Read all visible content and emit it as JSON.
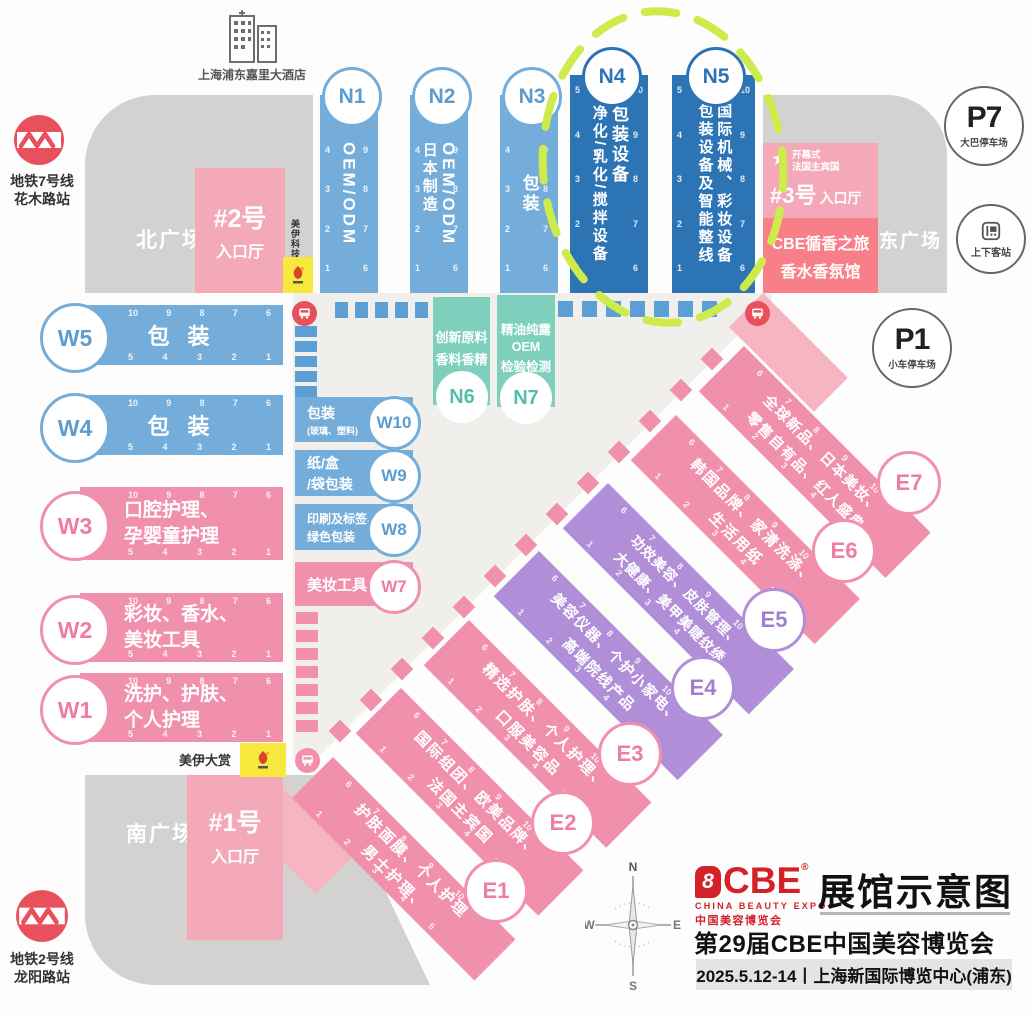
{
  "title_block": {
    "map_title": "展馆示意图",
    "expo_title": "第29届CBE中国美容博览会",
    "date_venue": "2025.5.12-14丨上海新国际博览中心(浦东)",
    "logo": {
      "mark": "8",
      "name": "CBE",
      "reg": "®",
      "en": "CHINA BEAUTY EXPO",
      "cn": "中国美容博览会"
    }
  },
  "compass": {
    "n": "N",
    "e": "E",
    "s": "S",
    "w": "W"
  },
  "transit": {
    "metro7": {
      "line": "地铁7号线",
      "station": "花木路站"
    },
    "metro2": {
      "line": "地铁2号线",
      "station": "龙阳路站"
    },
    "hotel": {
      "name": "上海浦东嘉里大酒店"
    },
    "p7": {
      "code": "P7",
      "label": "大巴停车场"
    },
    "p1": {
      "code": "P1",
      "label": "小车停车场"
    },
    "stop": {
      "label": "上下客站"
    }
  },
  "plazas": {
    "north": "北广场",
    "east": "东广场",
    "south": "南广场"
  },
  "entrances": {
    "no2": {
      "name": "#2号",
      "hall": "入口厅"
    },
    "no1": {
      "name": "#1号",
      "hall": "入口厅"
    },
    "no3": {
      "name": "#3号",
      "hall": "入口厅",
      "event1": "开幕式",
      "event2": "法国主宾国"
    }
  },
  "perfume_hall": {
    "line1": "CBE循香之旅",
    "line2": "香水香氛馆"
  },
  "sponsor": {
    "tech": "美伊科技",
    "award": "美伊大赏"
  },
  "n_halls": [
    {
      "id": "N1",
      "col1": "OEM/ODM"
    },
    {
      "id": "N2",
      "col1": "OEM/ODM",
      "col2": "日本制造"
    },
    {
      "id": "N3",
      "col1": "包装"
    },
    {
      "id": "N4",
      "col1": "包装设备",
      "col2": "净化/乳化/搅拌设备"
    },
    {
      "id": "N5",
      "col1": "国际机械、彩妆设备",
      "col2": "包装设备及智能整线"
    }
  ],
  "mid_halls": [
    {
      "id": "N6",
      "line1": "创新原料",
      "line2": "香料香精"
    },
    {
      "id": "N7",
      "line1": "精油纯露",
      "line2": "OEM",
      "line3": "检验检测"
    }
  ],
  "w_halls": [
    {
      "id": "W5",
      "line1": "包 装"
    },
    {
      "id": "W4",
      "line1": "包 装"
    },
    {
      "id": "W3",
      "line1": "口腔护理、",
      "line2": "孕婴童护理"
    },
    {
      "id": "W2",
      "line1": "彩妆、香水、",
      "line2": "美妆工具"
    },
    {
      "id": "W1",
      "line1": "洗护、护肤、",
      "line2": "个人护理"
    }
  ],
  "w_side_halls": [
    {
      "id": "W10",
      "line1": "包装",
      "line2": "(玻璃、塑料)"
    },
    {
      "id": "W9",
      "line1": "纸/盒",
      "line2": "/袋包装"
    },
    {
      "id": "W8",
      "line1": "印刷及标签、",
      "line2": "绿色包装"
    },
    {
      "id": "W7",
      "line1": "美妆工具"
    }
  ],
  "e_halls": [
    {
      "id": "E1",
      "line1": "护肤面膜、个人护理",
      "line2": "男士护理、"
    },
    {
      "id": "E2",
      "line1": "国际组团、欧美品牌、",
      "line2": "法国主宾国"
    },
    {
      "id": "E3",
      "line1": "精选护肤、个人护理、",
      "line2": "口服美容品"
    },
    {
      "id": "E4",
      "line1": "美容仪器、个护小家电、",
      "line2": "高端院线产品"
    },
    {
      "id": "E5",
      "line1": "功效美容、皮肤管理、",
      "line2": "大健康、美甲美睫纹绣"
    },
    {
      "id": "E6",
      "line1": "韩国品牌、家清洗涤、",
      "line2": "生活用纸"
    },
    {
      "id": "E7",
      "line1": "全球新品、日本美妆、",
      "line2": "零售自有品、红人盛典"
    }
  ],
  "ticks": {
    "h_top": [
      "10",
      "9",
      "8",
      "7",
      "6"
    ],
    "h_bottom": [
      "5",
      "4",
      "3",
      "2",
      "1"
    ],
    "v_left": [
      "5",
      "4",
      "3",
      "2",
      "1"
    ],
    "v_right": [
      "10",
      "9",
      "8",
      "7",
      "6"
    ],
    "d_top": [
      "6",
      "7",
      "8",
      "9",
      "10"
    ],
    "d_bottom": [
      "1",
      "2",
      "3",
      "4",
      "5"
    ]
  },
  "colors": {
    "hall_blue": "#74add9",
    "hall_dark_blue": "#2d74b5",
    "hall_teal": "#7fcfbd",
    "hall_pink": "#f190ad",
    "hall_purple": "#b18fd8",
    "entrance_pink": "#f4a9b8",
    "perfume_red": "#f87f88",
    "metro_red": "#e8505b",
    "sponsor_yellow": "#f8e83e",
    "dash_green": "#cdeb4b",
    "logo_red": "#d42027",
    "plaza_gray": "#d3d2d1"
  }
}
